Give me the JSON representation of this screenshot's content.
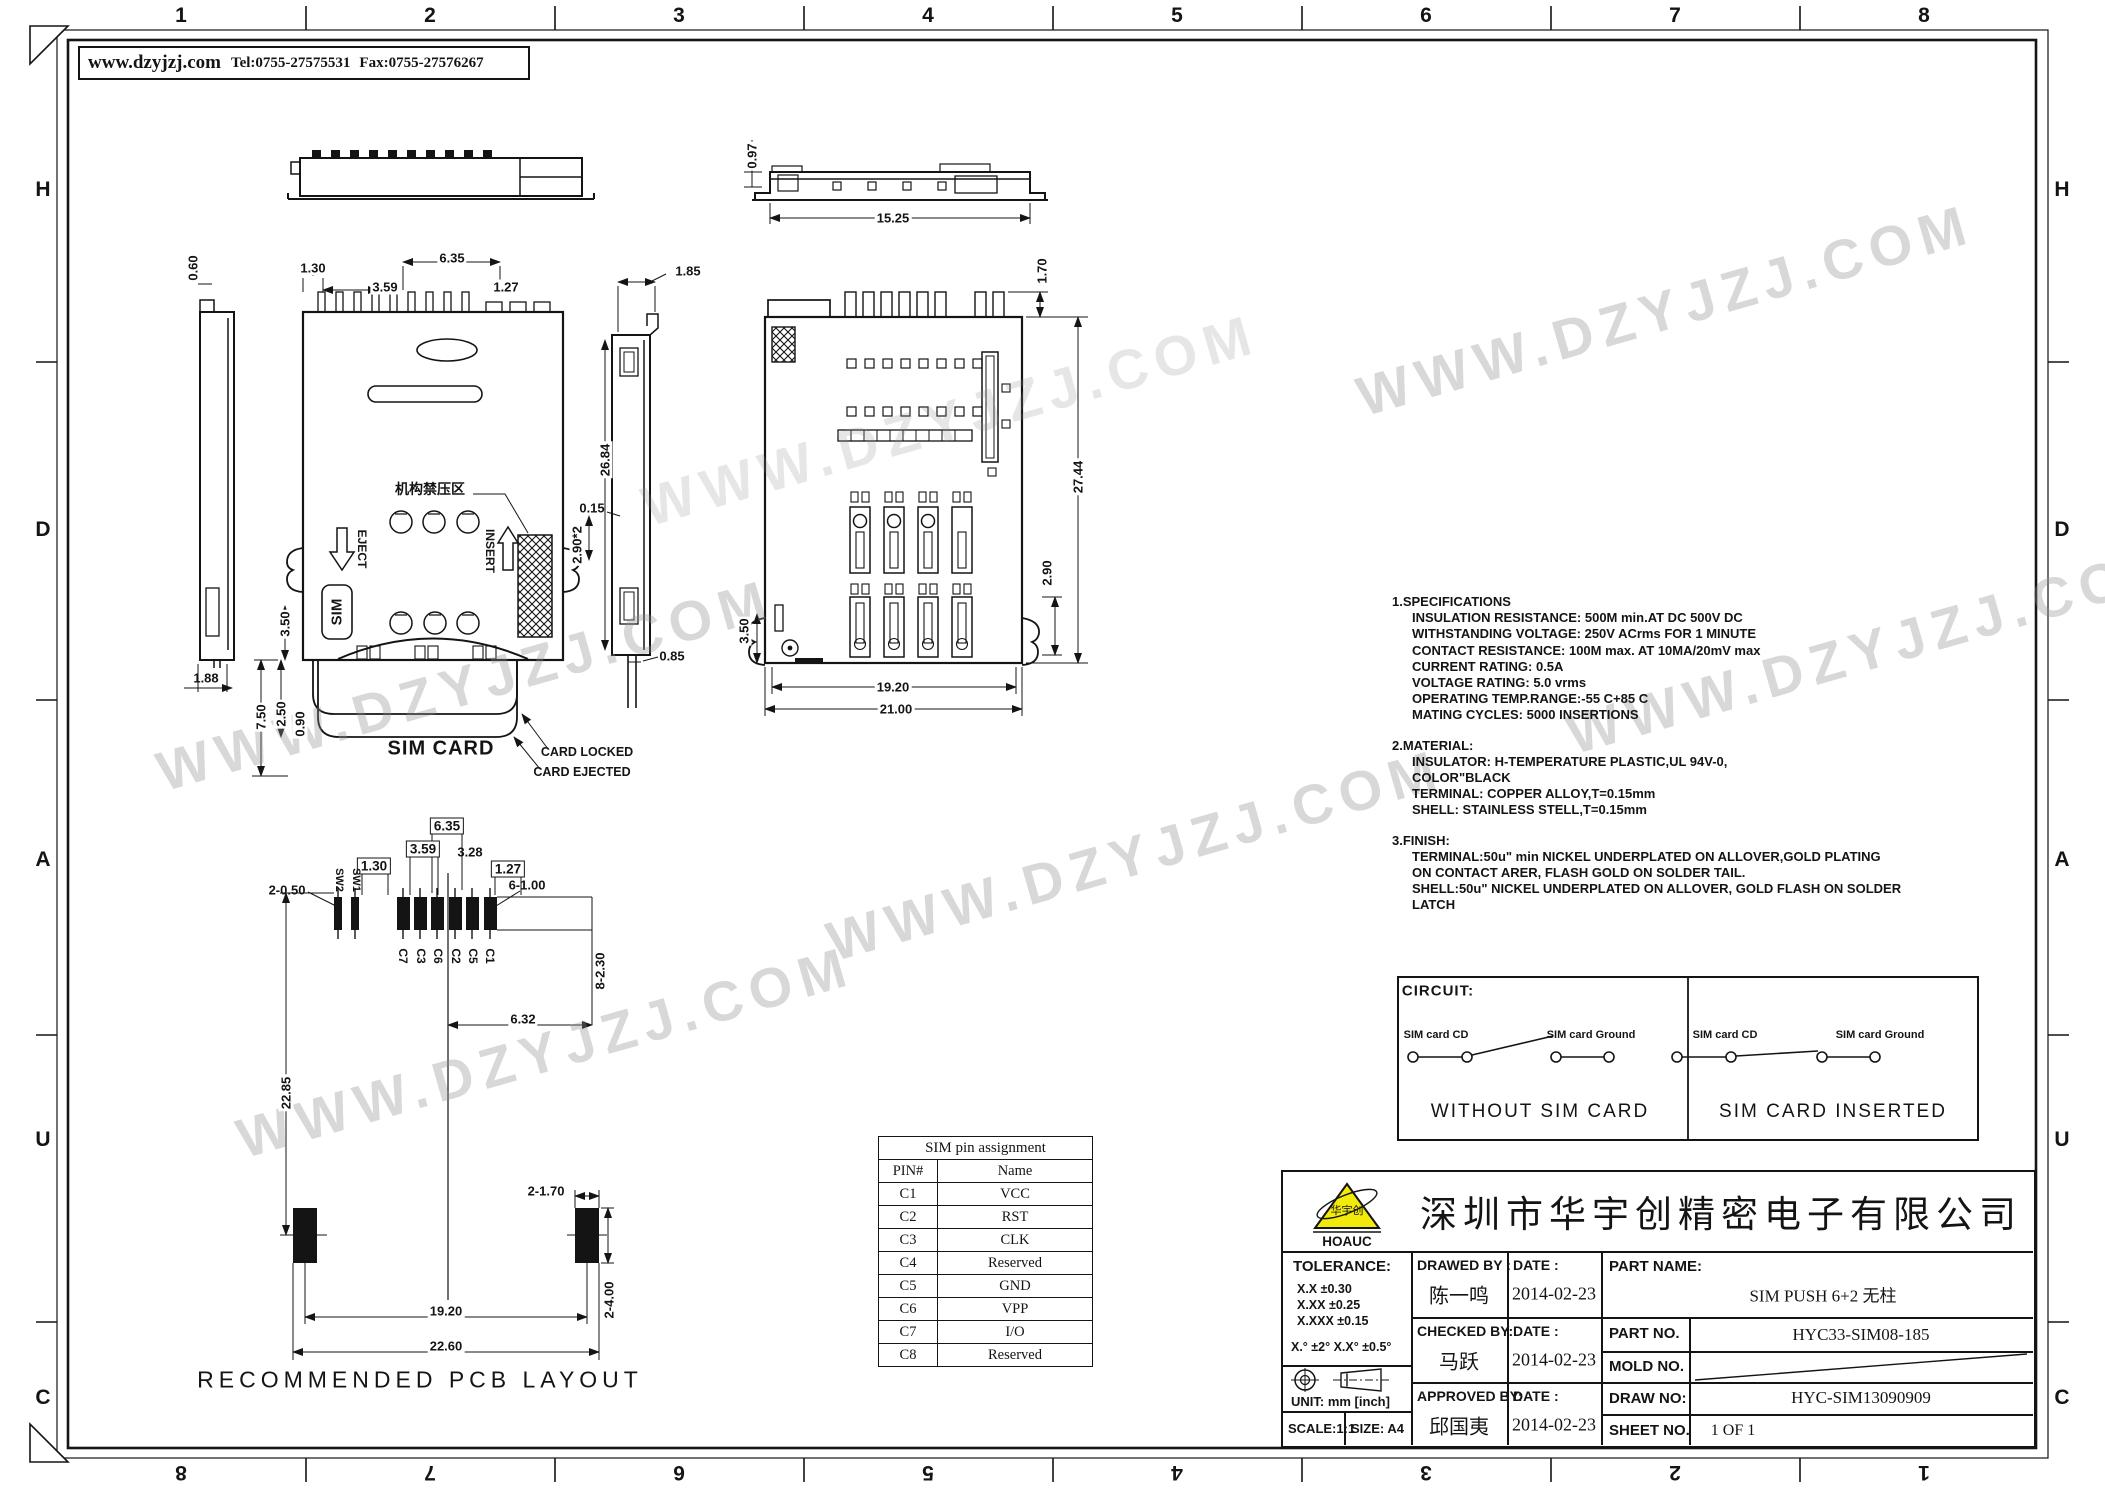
{
  "frame": {
    "top_numbers": [
      "1",
      "2",
      "3",
      "4",
      "5",
      "6",
      "7",
      "8"
    ],
    "bottom_numbers": [
      "8",
      "7",
      "6",
      "5",
      "4",
      "3",
      "2",
      "1"
    ],
    "left_letters": [
      "H",
      "D",
      "A",
      "U",
      "C"
    ],
    "right_letters": [
      "H",
      "D",
      "A",
      "U",
      "C"
    ]
  },
  "header": {
    "website": "www.dzyjzj.com",
    "tel": "Tel:0755-27575531",
    "fax": "Fax:0755-27576267"
  },
  "watermark": {
    "text": "WWW.DZYJZJ.COM"
  },
  "labels": {
    "mech_no_press": "机构禁压区",
    "eject": "EJECT",
    "insert": "INSERT",
    "sim": "SIM",
    "sim_card": "SIM CARD",
    "card_locked": "CARD LOCKED",
    "card_ejected": "CARD EJECTED",
    "pcb_caption": "RECOMMENDED PCB LAYOUT",
    "sw2": "SW2",
    "sw1": "SW1",
    "c7": "C7",
    "c3": "C3",
    "c6": "C6",
    "c2": "C2",
    "c5": "C5",
    "c1": "C1"
  },
  "dims": {
    "sv_097": "0.97",
    "sv_1525": "15.25",
    "fv_060": "0.60",
    "fv_130": "1.30",
    "fv_359": "3.59",
    "fv_635": "6.35",
    "fv_127": "1.27",
    "fv_185": "1.85",
    "fv_2684": "26.84",
    "fv_015": "0.15",
    "fv_290x2": "2.90*2",
    "fv_350": "3.50",
    "fv_188": "1.88",
    "fv_750": "7.50",
    "fv_250": "2.50",
    "fv_090": "0.90",
    "fv_085": "0.85",
    "bv_170": "1.70",
    "bv_2744": "27.44",
    "bv_290": "2.90",
    "bv_350": "3.50",
    "bv_1920": "19.20",
    "bv_2100": "21.00",
    "pc_635": "6.35",
    "pc_359": "3.59",
    "pc_130": "1.30",
    "pc_328": "3.28",
    "pc_127": "1.27",
    "pc_2_050": "2-0.50",
    "pc_6_100": "6-1.00",
    "pc_8_230": "8-2.30",
    "pc_632": "6.32",
    "pc_2285": "22.85",
    "pc_2_170": "2-1.70",
    "pc_1920": "19.20",
    "pc_2260": "22.60",
    "pc_2_400": "2-4.00"
  },
  "notes": {
    "spec_title": "1.SPECIFICATIONS",
    "spec_lines": [
      "INSULATION  RESISTANCE:  500M  min.AT  DC  500V  DC",
      "WITHSTANDING  VOLTAGE:    250V  ACrms  FOR  1  MINUTE",
      "CONTACT  RESISTANCE:  100M  max.  AT  10MA/20mV  max",
      "CURRENT  RATING:  0.5A",
      "VOLTAGE  RATING:  5.0  vrms",
      "OPERATING  TEMP.RANGE:-55  C+85  C",
      "MATING  CYCLES:  5000  INSERTIONS"
    ],
    "mat_title": "2.MATERIAL:",
    "mat_lines": [
      "INSULATOR:  H-TEMPERATURE  PLASTIC,UL  94V-0,",
      "COLOR\"BLACK",
      "TERMINAL:  COPPER  ALLOY,T=0.15mm",
      "SHELL:  STAINLESS  STELL,T=0.15mm"
    ],
    "fin_title": "3.FINISH:",
    "fin_lines": [
      "TERMINAL:50u\"  min  NICKEL  UNDERPLATED  ON  ALLOVER,GOLD  PLATING",
      "ON  CONTACT  ARER,  FLASH  GOLD  ON  SOLDER  TAIL.",
      "SHELL:50u\"  NICKEL  UNDERPLATED  ON  ALLOVER,  GOLD  FLASH  ON  SOLDER",
      "LATCH"
    ]
  },
  "circuit": {
    "title": "CIRCUIT:",
    "cd_label": "SIM card CD",
    "ground_label": "SIM card Ground",
    "without_caption": "WITHOUT SIM CARD",
    "inserted_caption": "SIM CARD INSERTED"
  },
  "pin_table": {
    "title": "SIM pin assignment",
    "col_pin": "PIN#",
    "col_name": "Name",
    "rows": [
      {
        "pin": "C1",
        "name": "VCC"
      },
      {
        "pin": "C2",
        "name": "RST"
      },
      {
        "pin": "C3",
        "name": "CLK"
      },
      {
        "pin": "C4",
        "name": "Reserved"
      },
      {
        "pin": "C5",
        "name": "GND"
      },
      {
        "pin": "C6",
        "name": "VPP"
      },
      {
        "pin": "C7",
        "name": "I/O"
      },
      {
        "pin": "C8",
        "name": "Reserved"
      }
    ]
  },
  "titleblock": {
    "company": "深圳市华宇创精密电子有限公司",
    "logo": {
      "brand": "HOAUC",
      "mark": "华宇创"
    },
    "tolerance": {
      "title": "TOLERANCE:",
      "row1": "X.X      ±0.30",
      "row2": "X.XX    ±0.25",
      "row3": "X.XXX  ±0.15",
      "angles": "X.°  ±2°       X.X°  ±0.5°"
    },
    "unit": "UNIT:  mm  [inch]",
    "scale": "SCALE:1:1",
    "size": "SIZE:  A4",
    "drawed": {
      "label": "DRAWED  BY  :",
      "name": "陈一鸣",
      "date_label": "DATE  :",
      "date": "2014-02-23"
    },
    "checked": {
      "label": "CHECKED  BY:",
      "name": "马跃",
      "date_label": "DATE  :",
      "date": "2014-02-23"
    },
    "approved": {
      "label": "APPROVED  BY:",
      "name": "邱国夷",
      "date_label": "DATE  :",
      "date": "2014-02-23"
    },
    "part_name": {
      "label": "PART  NAME:",
      "value": "SIM PUSH 6+2 无柱"
    },
    "part_no": {
      "label": "PART  NO.",
      "value": "HYC33-SIM08-185"
    },
    "mold_no": {
      "label": "MOLD  NO."
    },
    "draw_no": {
      "label": "DRAW  NO:",
      "value": "HYC-SIM13090909"
    },
    "sheet_no": {
      "label": "SHEET  NO.",
      "value": "1 OF 1"
    }
  }
}
